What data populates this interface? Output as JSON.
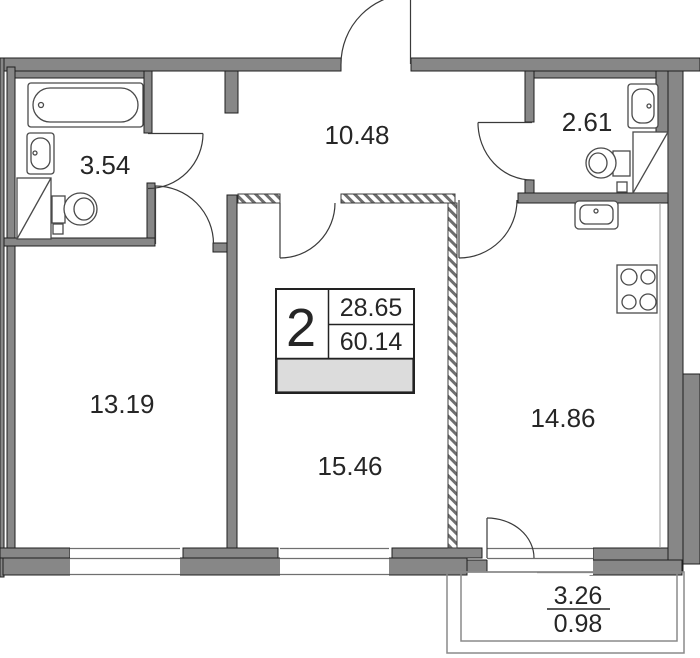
{
  "floorplan": {
    "areas": {
      "bathroom1": "3.54",
      "hallway": "10.48",
      "bathroom2": "2.61",
      "bedroom": "13.19",
      "living_room": "15.46",
      "kitchen": "14.86"
    },
    "stamp": {
      "rooms_count": "2",
      "living_area": "28.65",
      "total_area": "60.14"
    },
    "balcony": {
      "area": "3.26",
      "area_reduced": "0.98"
    },
    "colors": {
      "wall": "#878787",
      "outline": "#1f1f1f",
      "stamp_bar": "#dcdcdc"
    }
  }
}
